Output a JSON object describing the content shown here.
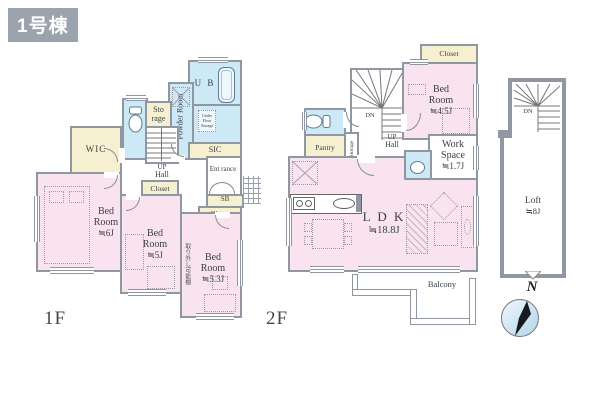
{
  "title": "1号棟",
  "colors": {
    "room_pink": "#f8e3ee",
    "wet_area_blue": "#cde9f5",
    "closet_cream": "#f6f0d1",
    "wall_gray": "#8f97a2",
    "title_badge_bg": "#9ba3ac"
  },
  "floor1": {
    "label": "1F",
    "wic": "WIC",
    "storage": "Sto rage",
    "powder_room": "Powder Room",
    "unit_bath": "U B",
    "under_floor_storage": "Under Floor Storage",
    "sic": "SIC",
    "up": "UP",
    "hall": "Hall",
    "entrance": "Ent rance",
    "shoe_box": "SB",
    "closet_5j": "Closet",
    "closet_53j": "Closet",
    "bedroom_6j": {
      "name": "Bed Room",
      "size": "≒6J"
    },
    "bedroom_5j": {
      "name": "Bed Room",
      "size": "≒5J"
    },
    "bedroom_53j": {
      "name": "Bed Room",
      "size": "≒5.3J"
    },
    "removable_shelf_note": "取り外し可能棚"
  },
  "floor2": {
    "label": "2F",
    "closet": "Closet",
    "bedroom_45j": {
      "name": "Bed Room",
      "size": "≒4.5J"
    },
    "work_space": {
      "name": "Work Space",
      "size": "≒1.7J"
    },
    "pantry": "Pantry",
    "storage": "Storage",
    "dn": "DN",
    "up": "UP",
    "hall": "Hall",
    "ldk": {
      "name": "L D K",
      "size": "≒18.8J"
    },
    "balcony": "Balcony"
  },
  "loft": {
    "name": "Loft",
    "size": "≒8J",
    "dn": "DN"
  },
  "compass_n": "N"
}
